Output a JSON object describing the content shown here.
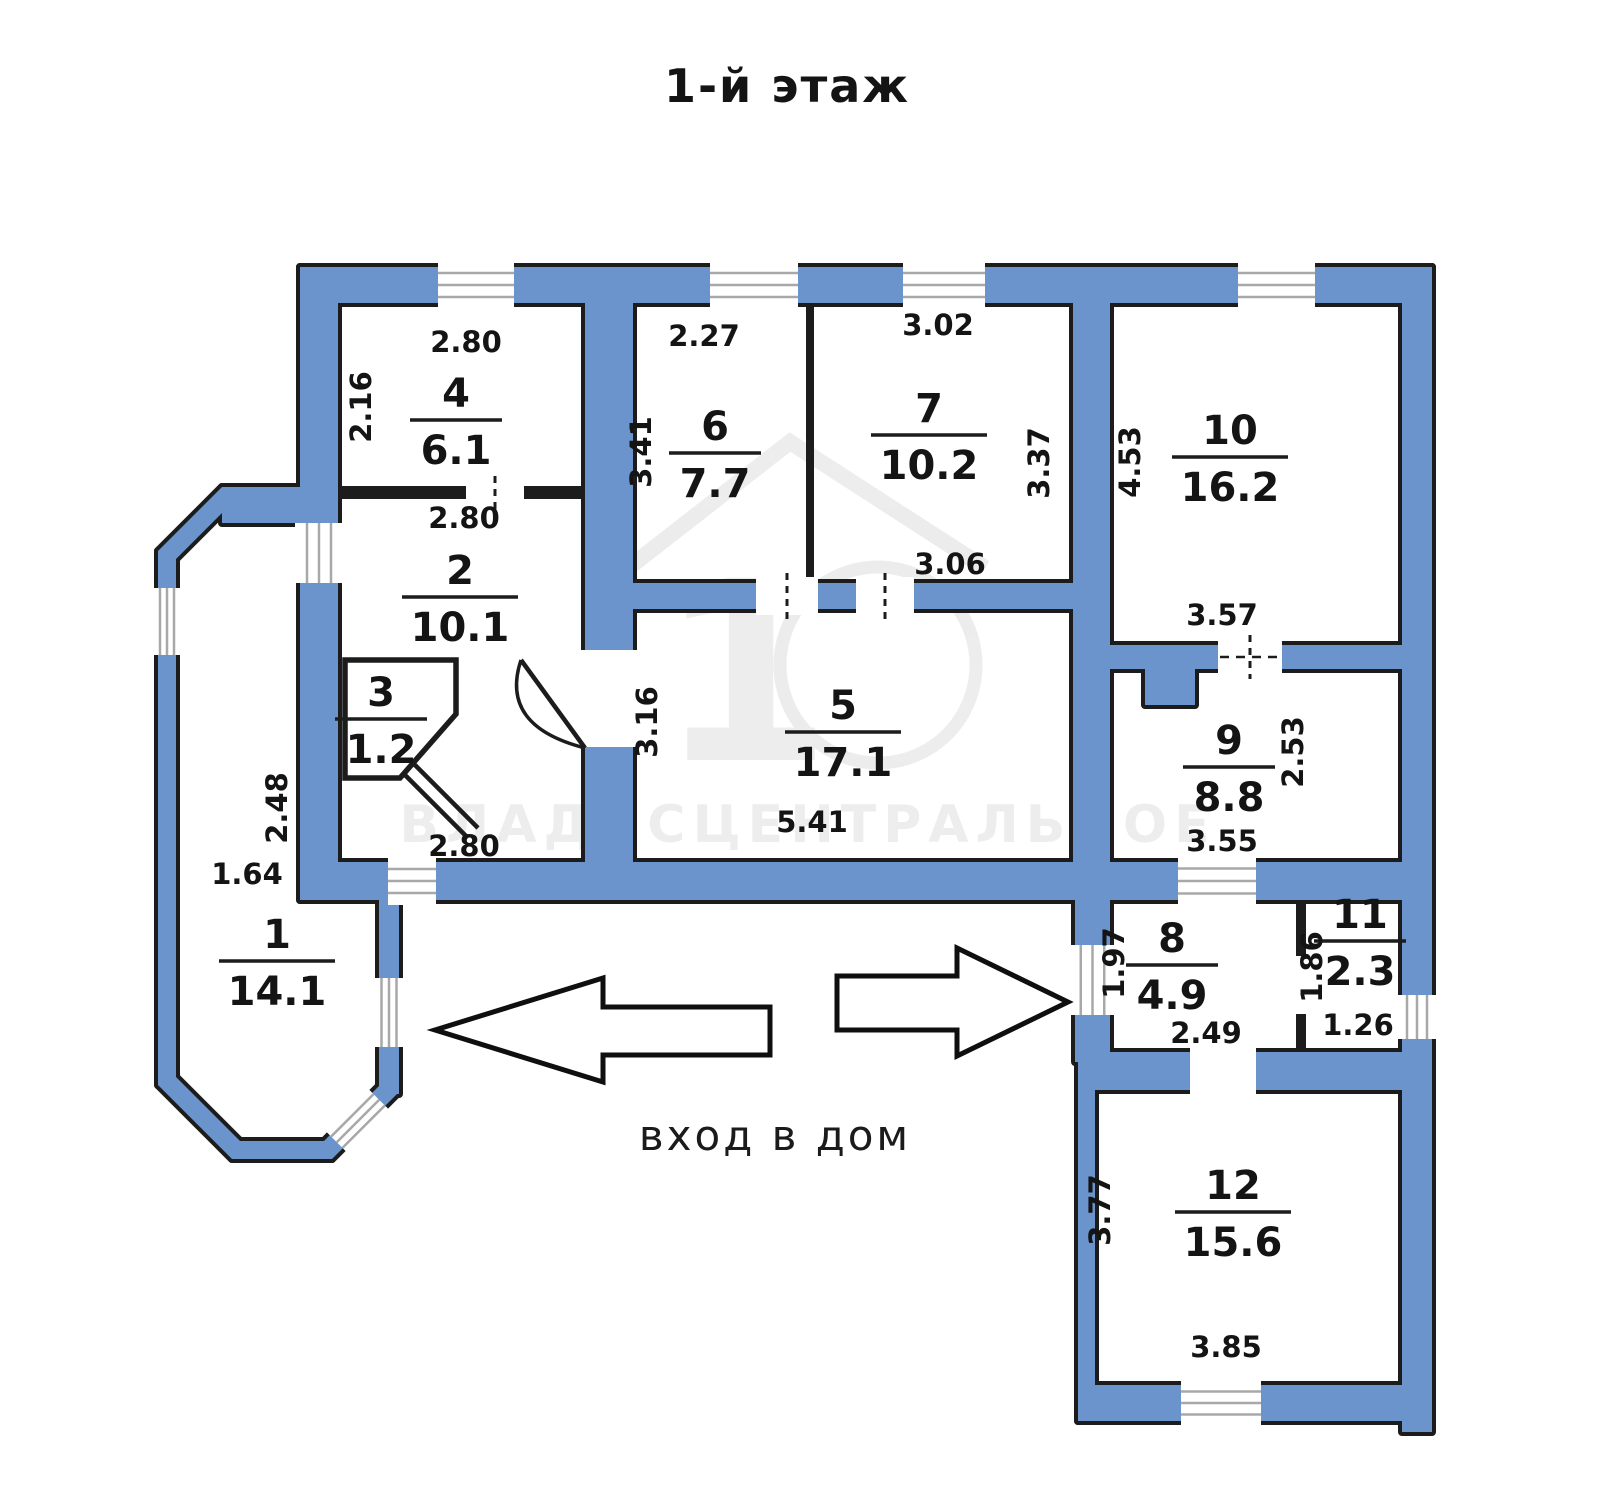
{
  "title": "1-й этаж",
  "entrance_label": "вход в дом",
  "watermark": {
    "logo_number": "1",
    "text": "ВЛАДИСЦЕНТРАЛЬНОЕ"
  },
  "colors": {
    "wall_fill": "#6b94cd",
    "outline": "#1c1c1c",
    "window_line": "#a8a8a8",
    "text": "#141414"
  },
  "rooms": [
    {
      "number": "1",
      "area": "14.1",
      "x": 277,
      "y": 948
    },
    {
      "number": "2",
      "area": "10.1",
      "x": 460,
      "y": 584
    },
    {
      "number": "3",
      "area": "1.2",
      "x": 381,
      "y": 706
    },
    {
      "number": "4",
      "area": "6.1",
      "x": 456,
      "y": 407
    },
    {
      "number": "5",
      "area": "17.1",
      "x": 843,
      "y": 719
    },
    {
      "number": "6",
      "area": "7.7",
      "x": 715,
      "y": 440
    },
    {
      "number": "7",
      "area": "10.2",
      "x": 929,
      "y": 422
    },
    {
      "number": "8",
      "area": "4.9",
      "x": 1172,
      "y": 952
    },
    {
      "number": "9",
      "area": "8.8",
      "x": 1229,
      "y": 754
    },
    {
      "number": "10",
      "area": "16.2",
      "x": 1230,
      "y": 444
    },
    {
      "number": "11",
      "area": "2.3",
      "x": 1360,
      "y": 928
    },
    {
      "number": "12",
      "area": "15.6",
      "x": 1233,
      "y": 1199
    }
  ],
  "dimensions": [
    {
      "text": "2.80",
      "x": 466,
      "y": 352,
      "rotate": false
    },
    {
      "text": "2.16",
      "x": 371,
      "y": 407,
      "rotate": true
    },
    {
      "text": "2.27",
      "x": 704,
      "y": 346,
      "rotate": false
    },
    {
      "text": "3.41",
      "x": 651,
      "y": 452,
      "rotate": true
    },
    {
      "text": "3.02",
      "x": 938,
      "y": 335,
      "rotate": false
    },
    {
      "text": "3.37",
      "x": 1049,
      "y": 463,
      "rotate": true
    },
    {
      "text": "3.06",
      "x": 950,
      "y": 574,
      "rotate": false
    },
    {
      "text": "4.53",
      "x": 1140,
      "y": 462,
      "rotate": true
    },
    {
      "text": "3.57",
      "x": 1222,
      "y": 625,
      "rotate": false
    },
    {
      "text": "2.80",
      "x": 464,
      "y": 528,
      "rotate": false
    },
    {
      "text": "2.80",
      "x": 464,
      "y": 856,
      "rotate": false
    },
    {
      "text": "3.16",
      "x": 657,
      "y": 722,
      "rotate": true
    },
    {
      "text": "5.41",
      "x": 812,
      "y": 832,
      "rotate": false
    },
    {
      "text": "2.53",
      "x": 1303,
      "y": 752,
      "rotate": true
    },
    {
      "text": "3.55",
      "x": 1222,
      "y": 851,
      "rotate": false
    },
    {
      "text": "2.48",
      "x": 287,
      "y": 808,
      "rotate": true
    },
    {
      "text": "1.64",
      "x": 247,
      "y": 884,
      "rotate": false
    },
    {
      "text": "1.97",
      "x": 1124,
      "y": 963,
      "rotate": true
    },
    {
      "text": "2.49",
      "x": 1206,
      "y": 1043,
      "rotate": false
    },
    {
      "text": "1.86",
      "x": 1322,
      "y": 967,
      "rotate": true
    },
    {
      "text": "1.26",
      "x": 1358,
      "y": 1035,
      "rotate": false
    },
    {
      "text": "3.77",
      "x": 1110,
      "y": 1210,
      "rotate": true
    },
    {
      "text": "3.85",
      "x": 1226,
      "y": 1357,
      "rotate": false
    }
  ]
}
